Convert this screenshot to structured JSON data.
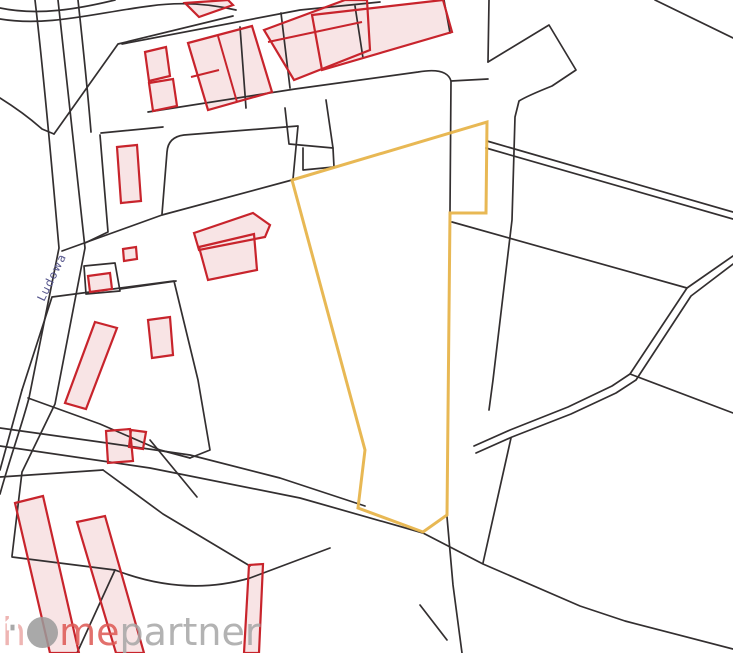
{
  "canvas": {
    "width": 733,
    "height": 653,
    "background": "#FFFFFF"
  },
  "colors": {
    "parcel_line": "#332F30",
    "building_stroke": "#C8242C",
    "building_fill": "#F8E4E5",
    "highlight": "#E7B44B",
    "street_label": "#55558C",
    "watermark_h": "#ECA9A6",
    "watermark_me": "#DE5853",
    "watermark_gray": "#A6A6A6",
    "watermark_circle": "#9B9B9B"
  },
  "street_label": {
    "text": "Ludowa",
    "x": 44,
    "y": 302,
    "rotation": -64,
    "font_size": 11.5
  },
  "watermark": {
    "h": "h",
    "me": "me",
    "partner": "partner",
    "icon": "house-in-circle"
  },
  "highlight_parcel": {
    "id": "highlighted-parcel",
    "points": "292,180 487,122 486,213 450,213 447,515 423,532 358,508 365,450",
    "stroke_width": 3
  },
  "map": {
    "parcel_lines": [
      {
        "id": "road-curve-upper",
        "d": "M0,8 C38,16 78,9 115,0"
      },
      {
        "id": "road-curve-lower",
        "d": "M0,19 C48,27 95,13 150,6 C178,2 206,3 236,10"
      },
      {
        "id": "road-left-outer",
        "d": "M35,0 C45,85 52,170 59,248 L29,398 C21,428 10,458 0,494"
      },
      {
        "id": "road-left-inner",
        "d": "M58,0 C68,85 77,170 85,248 L55,404 L22,472 L12,556"
      },
      {
        "id": "road-left-third",
        "d": "M78,0 C84,55 88,95 91,132"
      },
      {
        "id": "corner-arc",
        "d": "M0,98 Q24,113 42,129 L54,134"
      },
      {
        "id": "cluster-west-edge",
        "d": "M54,134 L118,44 L233,16"
      },
      {
        "id": "cluster-top-line",
        "d": "M122,44 L300,10 L380,2"
      },
      {
        "id": "band-bottom-line",
        "d": "M148,112 L295,89 L418,72 Q447,67 451,81 L450,211"
      },
      {
        "id": "band-inner-line",
        "d": "M101,133 L163,127"
      },
      {
        "id": "top-right-horizontal",
        "d": "M451,81 L488,79"
      },
      {
        "id": "top-right-vertical",
        "d": "M489,0 L488,62"
      },
      {
        "id": "pentagon-and-tail",
        "d": "M488,62 L549,25 L576,70 L552,86 Q527,96 519,101 L515,117 L512,220 L493,380 L489,410"
      },
      {
        "id": "tail-lower",
        "d": "M511,438 L483,563"
      },
      {
        "id": "stepped-parcel-a",
        "d": "M285,108 L289,144 L333,148 L326,100"
      },
      {
        "id": "stepped-parcel-b",
        "d": "M303,148 L303,170 L334,167 L333,148"
      },
      {
        "id": "rounded-parcel",
        "d": "M162,214 L167,152 Q168,137 184,135 L298,126 L293,179"
      },
      {
        "id": "diag-to-highlight",
        "d": "M62,251 L162,215 L292,180"
      },
      {
        "id": "corridor-left",
        "d": "M100,135 L108,232 L85,243"
      },
      {
        "id": "small-parcel-box",
        "d": "M84,266 L115,263 L120,291 L86,294 Z"
      },
      {
        "id": "box-extension",
        "d": "M120,289 L176,281"
      },
      {
        "id": "parcel-mid-left",
        "d": "M22,390 L52,297 L174,281 L198,380 L210,450 L190,458"
      },
      {
        "id": "parcel-mid-left-west",
        "d": "M22,390 L0,470"
      },
      {
        "id": "parcel-mid-left-bottom",
        "d": "M28,398 L100,424 L160,450 L190,458"
      },
      {
        "id": "bottom-band-1",
        "d": "M0,428 L100,442 L190,455 L280,478 L365,506"
      },
      {
        "id": "bottom-band-2",
        "d": "M0,446 L150,468 L300,498 L423,533 L483,564 L580,606 L625,621 L733,649"
      },
      {
        "id": "bottom-band-flat",
        "d": "M0,477 L103,470"
      },
      {
        "id": "bottom-band-steep",
        "d": "M103,470 L163,514 L250,566"
      },
      {
        "id": "steep-short",
        "d": "M150,440 L197,497"
      },
      {
        "id": "lower-left-a",
        "d": "M12,557 L115,570"
      },
      {
        "id": "lower-left-b",
        "d": "M115,570 L77,653"
      },
      {
        "id": "lower-left-curve",
        "d": "M115,570 Q185,597 250,578 L330,548"
      },
      {
        "id": "below-highlight-vert",
        "d": "M447,517 L453,585 L462,653"
      },
      {
        "id": "below-highlight-diag",
        "d": "M420,605 L447,640"
      },
      {
        "id": "single-diag-east",
        "d": "M452,222 L687,288"
      },
      {
        "id": "east-branch",
        "d": "M630,374 L733,413"
      },
      {
        "id": "top-right-diag",
        "d": "M655,0 L733,38"
      },
      {
        "id": "double-road-1a",
        "d": "M487,141 L733,212"
      },
      {
        "id": "double-road-1b",
        "d": "M486,148 L733,219"
      },
      {
        "id": "double-road-2a",
        "d": "M733,256 L687,288 L630,374 L612,386 L568,407 L510,430 L474,446"
      },
      {
        "id": "double-road-2b",
        "d": "M733,264 L691,296 L636,380 L616,393 L571,414 L512,437 L476,453"
      },
      {
        "id": "big-right-vert",
        "d": "M444,0 L450,33"
      },
      {
        "id": "band-divider-1",
        "d": "M240,27 L246,108"
      },
      {
        "id": "band-divider-2",
        "d": "M281,13 L290,88"
      },
      {
        "id": "band-divider-3",
        "d": "M355,6 L363,58"
      }
    ],
    "buildings": [
      {
        "id": "building-partial-top",
        "points": "185,3 228,0 233,5 199,17"
      },
      {
        "id": "building-tall-top",
        "points": "264,30 345,0 367,0 370,50 294,80"
      },
      {
        "id": "building-large-top",
        "points": "312,15 443,0 452,32 322,70"
      },
      {
        "id": "building-double",
        "points": "188,43 252,26 272,92 208,110"
      },
      {
        "id": "building-sq1",
        "points": "145,52 166,47 170,76 149,81"
      },
      {
        "id": "building-sq2",
        "points": "149,83 173,79 177,106 153,111"
      },
      {
        "id": "building-vertical",
        "points": "117,147 137,145 141,201 121,203"
      },
      {
        "id": "building-lshape-bar",
        "points": "194,233 253,213 270,225 265,237 199,250"
      },
      {
        "id": "building-lshape-body",
        "points": "199,247 254,234 257,270 208,280"
      },
      {
        "id": "building-tiny",
        "points": "123,249 136,247 137,259 124,261"
      },
      {
        "id": "building-small-sq",
        "points": "88,276 110,273 112,289 90,292"
      },
      {
        "id": "building-long-thin",
        "points": "95,322 117,328 86,409 65,403"
      },
      {
        "id": "building-small-rot",
        "points": "148,320 170,317 173,355 152,358"
      },
      {
        "id": "building-pair-main",
        "points": "106,431 130,429 133,461 108,463"
      },
      {
        "id": "building-pair-small",
        "points": "131,430 146,432 143,449 129,447"
      },
      {
        "id": "building-strip-1",
        "points": "15,503 43,496 79,653 50,653"
      },
      {
        "id": "building-strip-2",
        "points": "77,522 105,516 144,653 116,653"
      },
      {
        "id": "building-strip-3",
        "points": "249,565 263,564 259,653 244,653"
      }
    ],
    "building_lines": [
      {
        "id": "building-divider-a1",
        "d": "M218,36 L237,102"
      },
      {
        "id": "building-divider-a2",
        "d": "M191,77 L219,70"
      },
      {
        "id": "building-divider-b",
        "d": "M268,42 L362,22"
      }
    ]
  }
}
